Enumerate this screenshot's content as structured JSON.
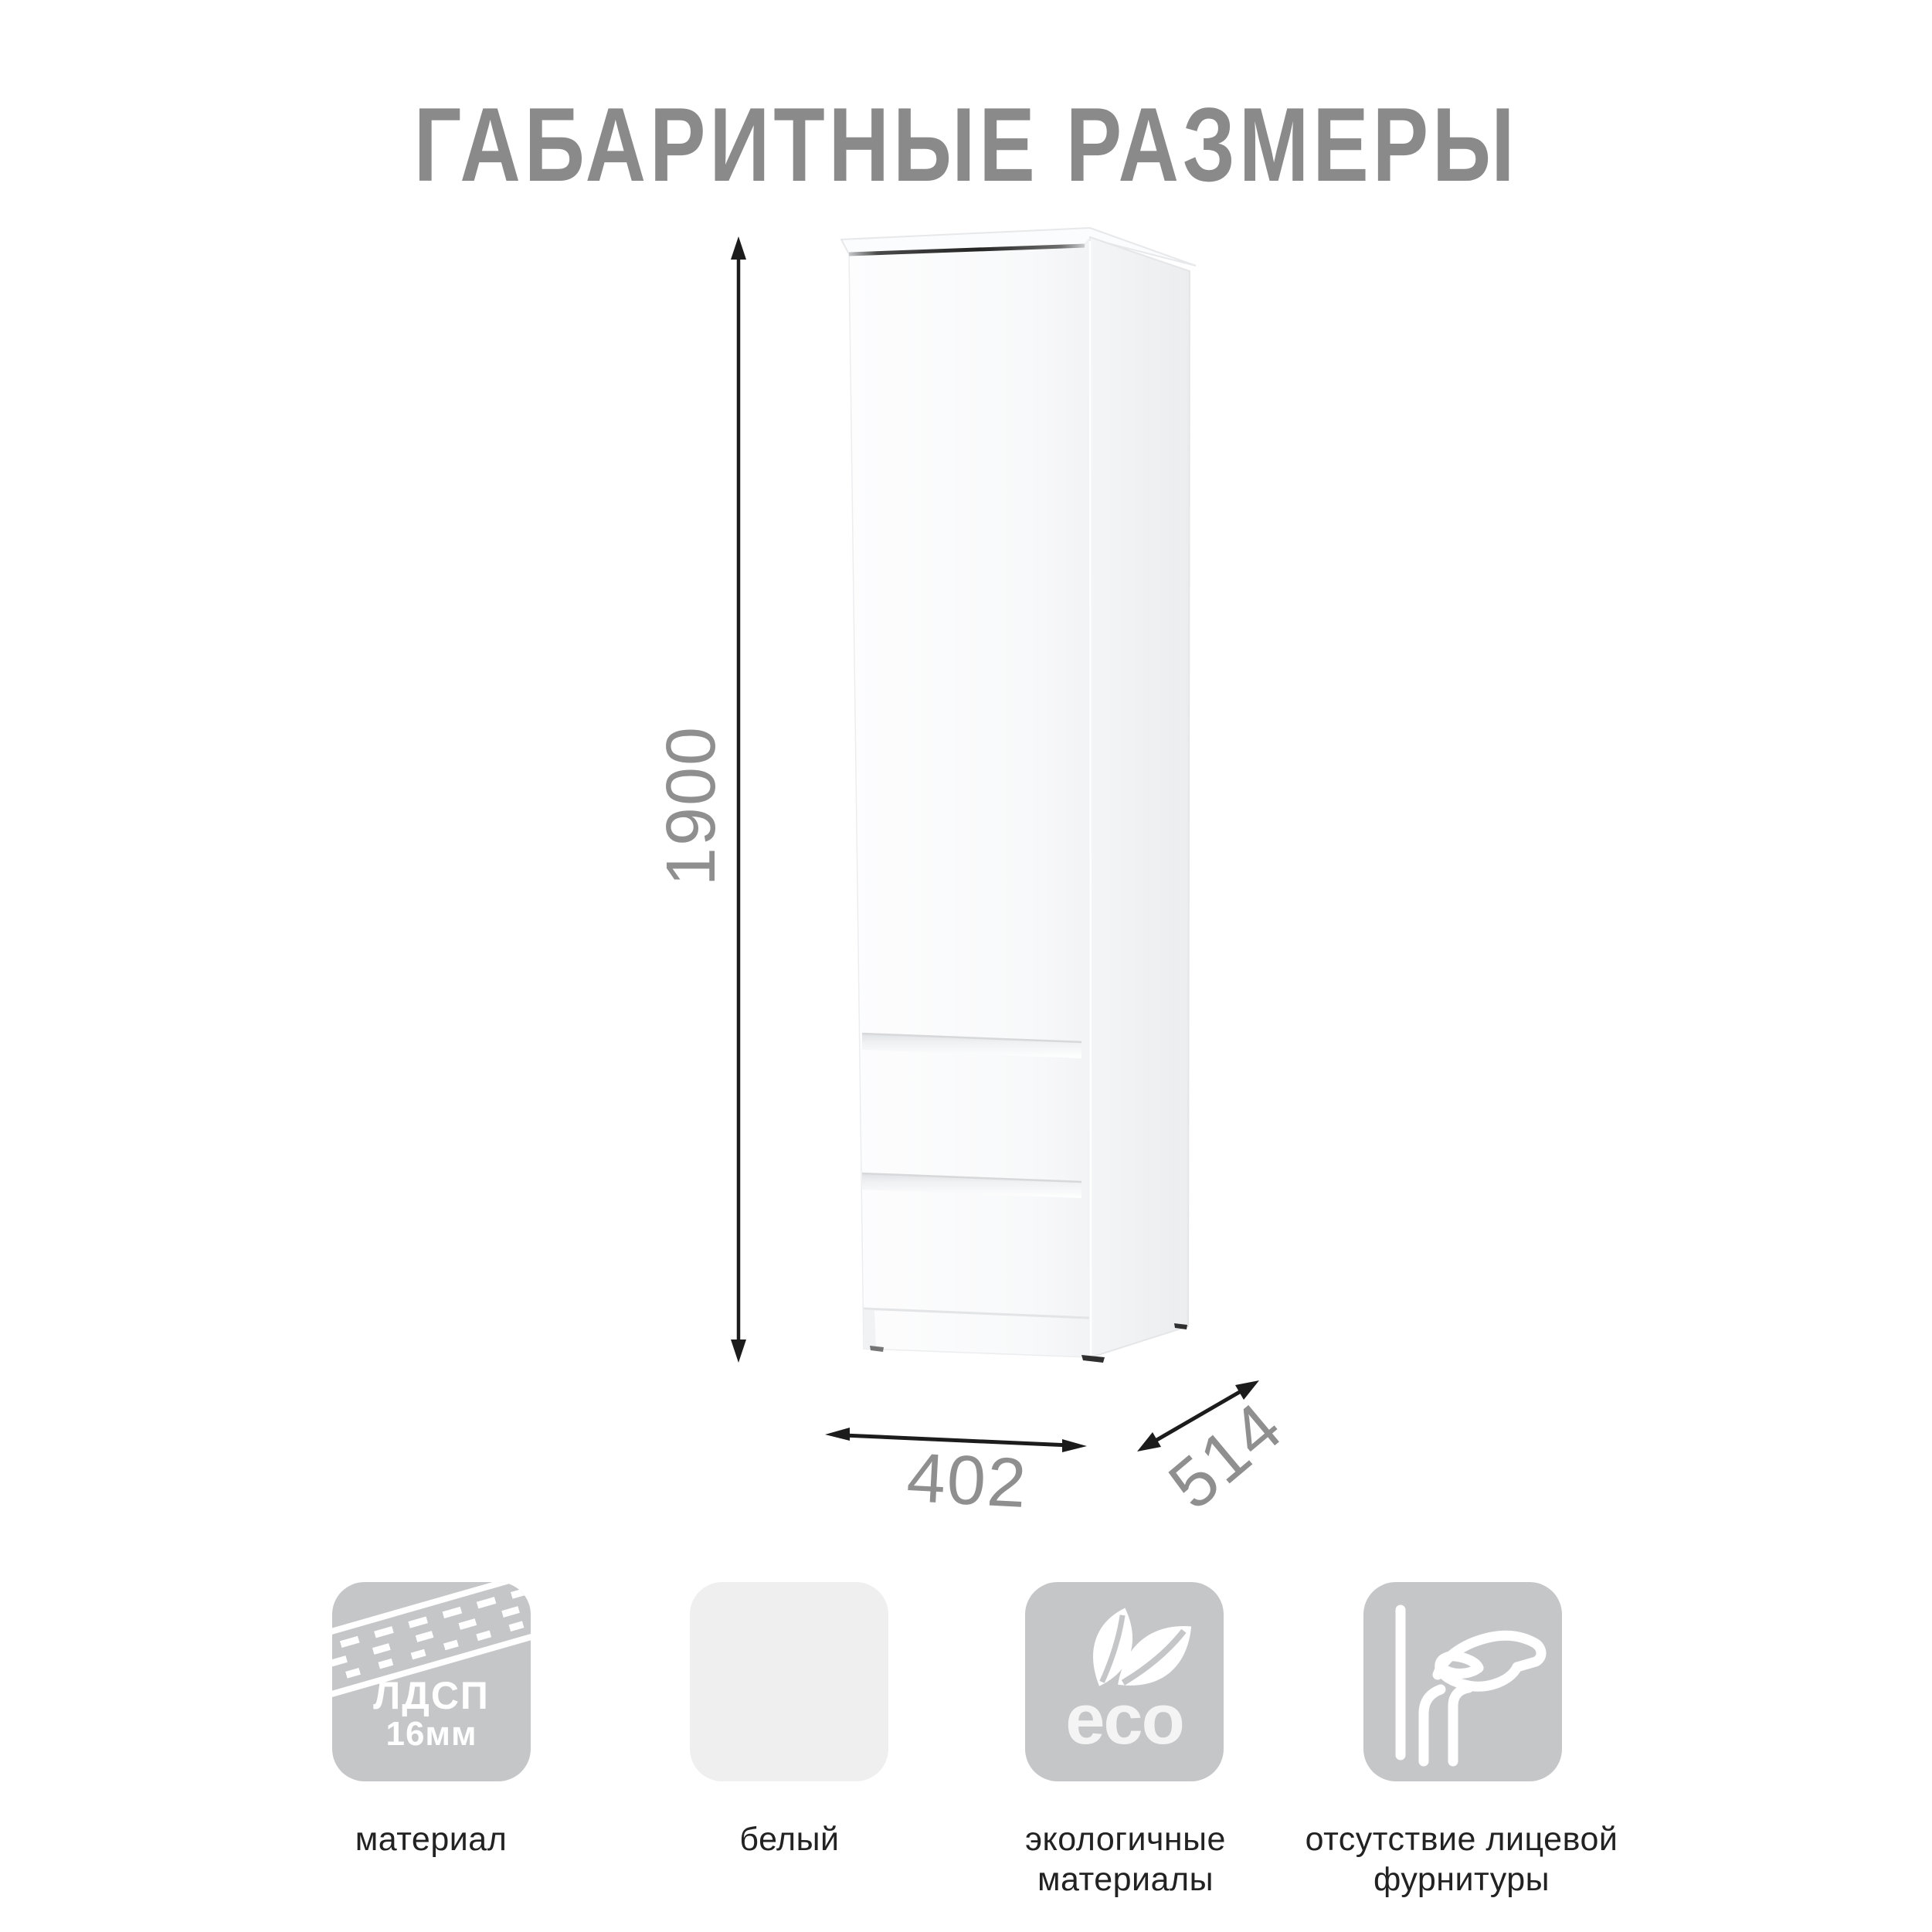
{
  "page": {
    "background": "#ffffff"
  },
  "title": {
    "text": "ГАБАРИТНЫЕ РАЗМЕРЫ",
    "color": "#8a8a8a"
  },
  "drawing": {
    "subject": "tall one-door cabinet with two lower drawers, white",
    "height_label": "1900",
    "width_label": "402",
    "depth_label": "514",
    "dim_label_color": "#8f8f8f",
    "arrow_color": "#1c1c1c",
    "cabinet_front_color": "#fbfcfd",
    "cabinet_side_color": "#eff0f2"
  },
  "features": [
    {
      "icon": "chipboard-texture-icon",
      "tile_color": "#c5c6c8",
      "badge_line1": "ЛДСП",
      "badge_line2": "16мм",
      "label": "материал"
    },
    {
      "icon": "white-color-swatch",
      "tile_color": "#efeff0",
      "label": "белый"
    },
    {
      "icon": "eco-leaves-icon",
      "tile_color": "#c5c6c8",
      "badge": "eco",
      "label": "экологичные материалы"
    },
    {
      "icon": "hand-grip-icon",
      "tile_color": "#c5c6c8",
      "label": "отсутствие лицевой фурнитуры"
    }
  ]
}
